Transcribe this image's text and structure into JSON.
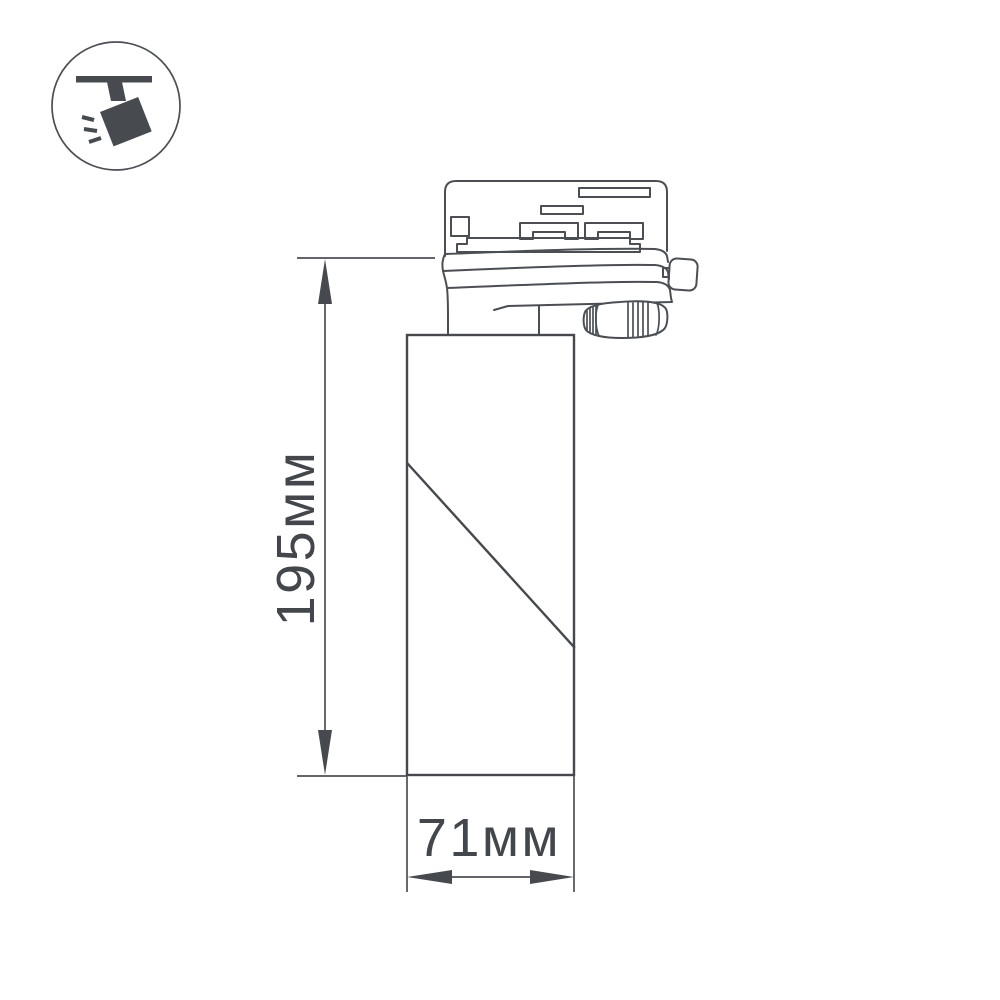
{
  "page": {
    "background": "#ffffff",
    "kind": "product technical dimension drawing",
    "subject": "track-mounted spotlight luminaire, side view"
  },
  "badge": {
    "icon": "track-spotlight-icon",
    "meaning": "ceiling track mounted directional spot",
    "color": "#474b50"
  },
  "drawing": {
    "line_color": "#4b4f54",
    "text_color": "#43474c",
    "parts": [
      "track-adapter-head",
      "contact-slots",
      "rotating-collar",
      "locking-lever",
      "adjustment-knob",
      "cylindrical-lamp-body"
    ]
  },
  "dimensions": {
    "height": {
      "label": "195мм",
      "value": 195,
      "unit": "мм",
      "orientation": "vertical"
    },
    "width": {
      "label": "71мм",
      "value": 71,
      "unit": "мм",
      "orientation": "horizontal"
    }
  }
}
